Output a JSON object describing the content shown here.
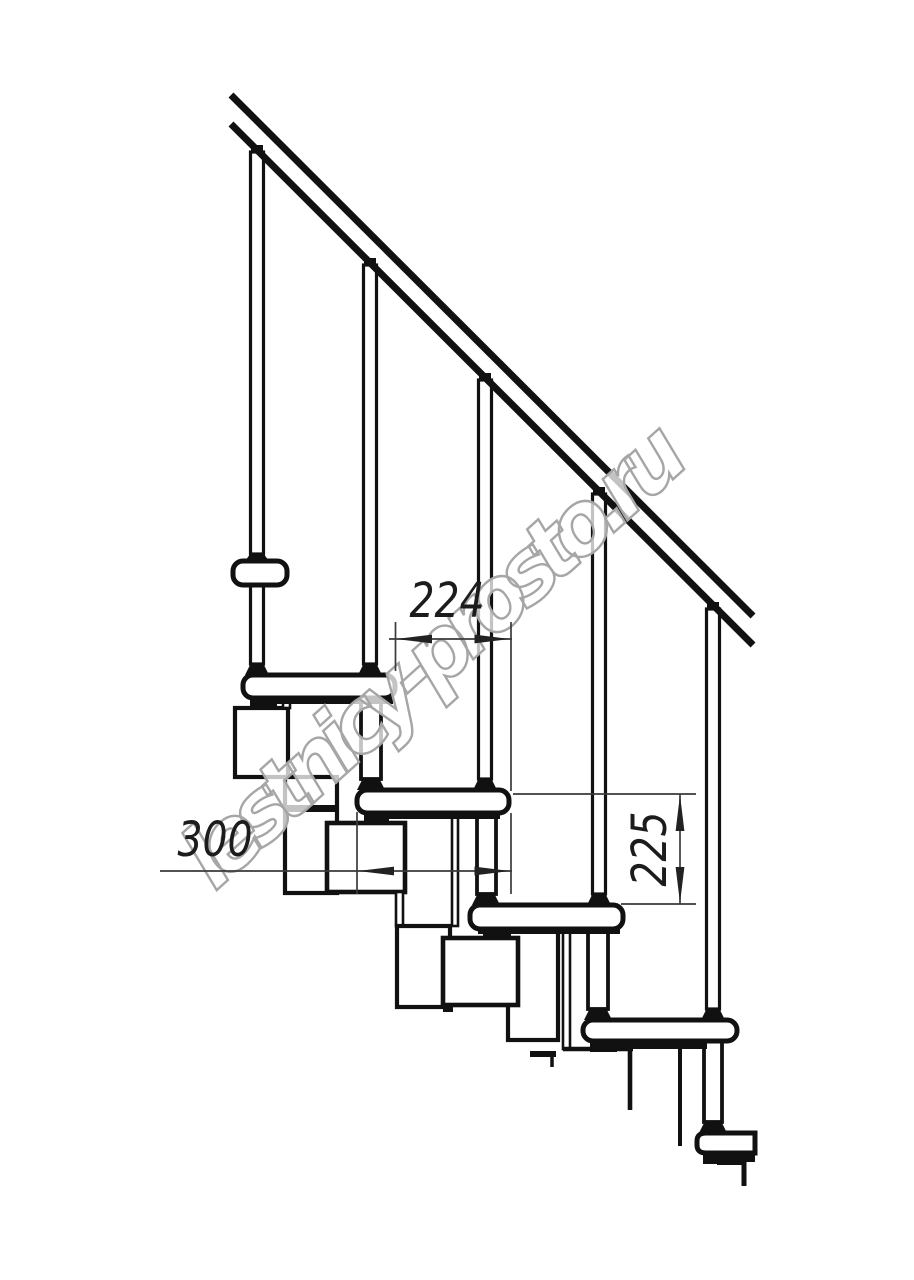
{
  "drawing": {
    "title": "modular staircase side elevation drawing",
    "watermark": {
      "text": "lestnicy-prosto.ru",
      "outline_color": "#a6a6a6"
    },
    "dimensions": {
      "going": {
        "value": "224",
        "orientation": "horizontal"
      },
      "tread_depth": {
        "value": "300",
        "orientation": "horizontal"
      },
      "rise": {
        "value": "225",
        "orientation": "vertical"
      }
    },
    "colors": {
      "line": "#111111",
      "dim_line": "#3a3a3a",
      "background": "#ffffff"
    },
    "counts": {
      "balusters": "5",
      "treads": "6"
    }
  }
}
